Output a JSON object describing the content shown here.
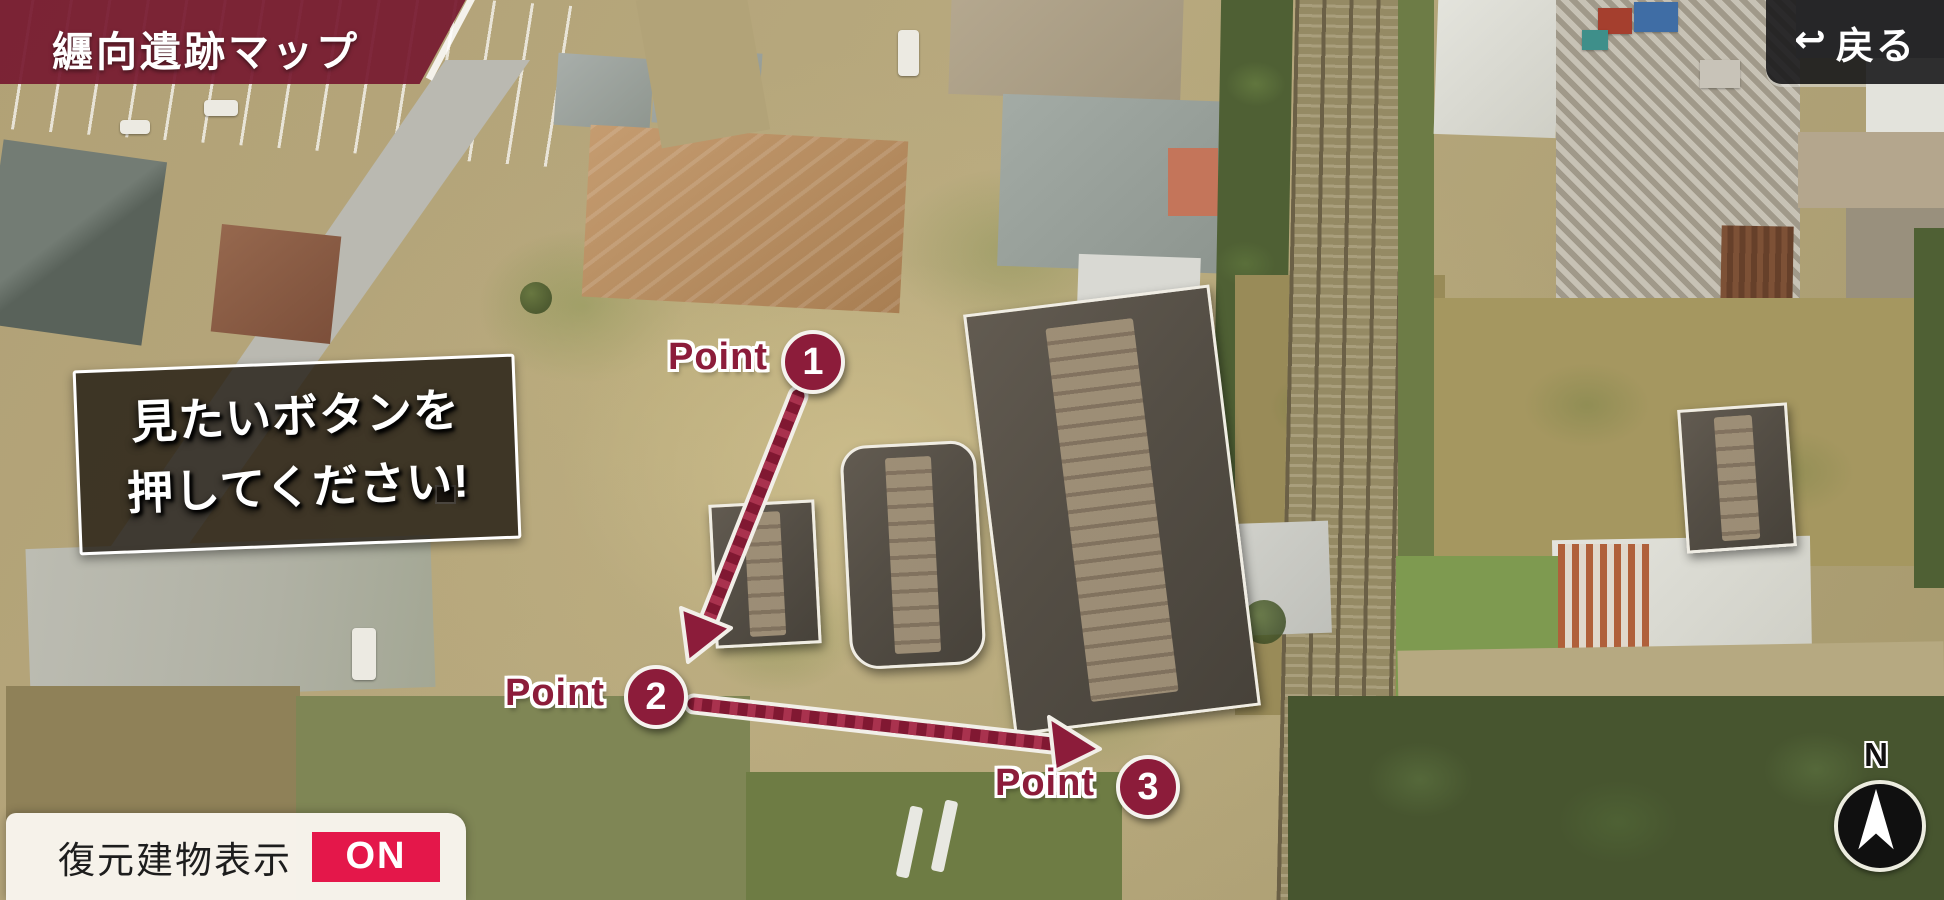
{
  "header": {
    "title": "纒向遺跡マップ",
    "back_label": "戻る",
    "back_icon": "↩"
  },
  "instruction": {
    "line1": "見たいボタンを",
    "line2": "押してください!"
  },
  "points": [
    {
      "label": "Point",
      "number": "1"
    },
    {
      "label": "Point",
      "number": "2"
    },
    {
      "label": "Point",
      "number": "3"
    }
  ],
  "toggle": {
    "label": "復元建物表示",
    "state": "ON"
  },
  "compass": {
    "north": "N"
  },
  "icons": {
    "back": "return-arrow-icon",
    "compass_needle": "north-arrow-icon"
  },
  "colors": {
    "banner": "#761a30",
    "marker_accent": "#8c1c3a",
    "toggle_on_badge": "#e4174a"
  }
}
